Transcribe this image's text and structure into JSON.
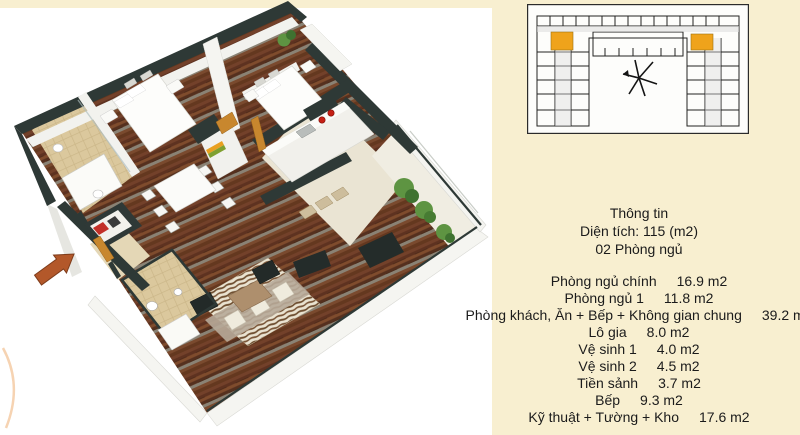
{
  "info_panel": {
    "title": "Thông tin",
    "area_line": "Diện tích: 115 (m2)",
    "bedrooms_line": "02 Phòng ngủ",
    "rooms": [
      {
        "label": "Phòng ngủ chính",
        "value": "16.9 m2"
      },
      {
        "label": "Phòng ngủ 1",
        "value": "11.8 m2"
      },
      {
        "label": "Phòng khách, Ăn + Bếp + Không gian chung",
        "value": "39.2 m2"
      },
      {
        "label": "Lô gia",
        "value": "8.0 m2"
      },
      {
        "label": "Vệ sinh 1",
        "value": "4.0 m2"
      },
      {
        "label": "Vệ sinh 2",
        "value": "4.5 m2"
      },
      {
        "label": "Tiền sảnh",
        "value": "3.7 m2"
      },
      {
        "label": "Bếp",
        "value": "9.3 m2"
      },
      {
        "label": "Kỹ thuật + Tường + Kho",
        "value": "17.6 m2"
      }
    ]
  },
  "key_plan": {
    "description": "building-floor-key-plan",
    "highlight_color": "#EFA31B"
  },
  "floor_plan": {
    "description": "3d-isometric-apartment-floor-plan",
    "colors": {
      "background_cream": "#F8EFD0",
      "plan_white": "#FFFFFF",
      "wall_dark": "#2E3936",
      "wood_floor": "#6E3B24",
      "bathroom_tile": "#DBC89D",
      "entrance_arrow": "#B3582A",
      "door_orange": "#C8872E",
      "cooktop_red": "#C52015",
      "plant_green": "#5E9442",
      "text": "#1B1B1B"
    }
  }
}
